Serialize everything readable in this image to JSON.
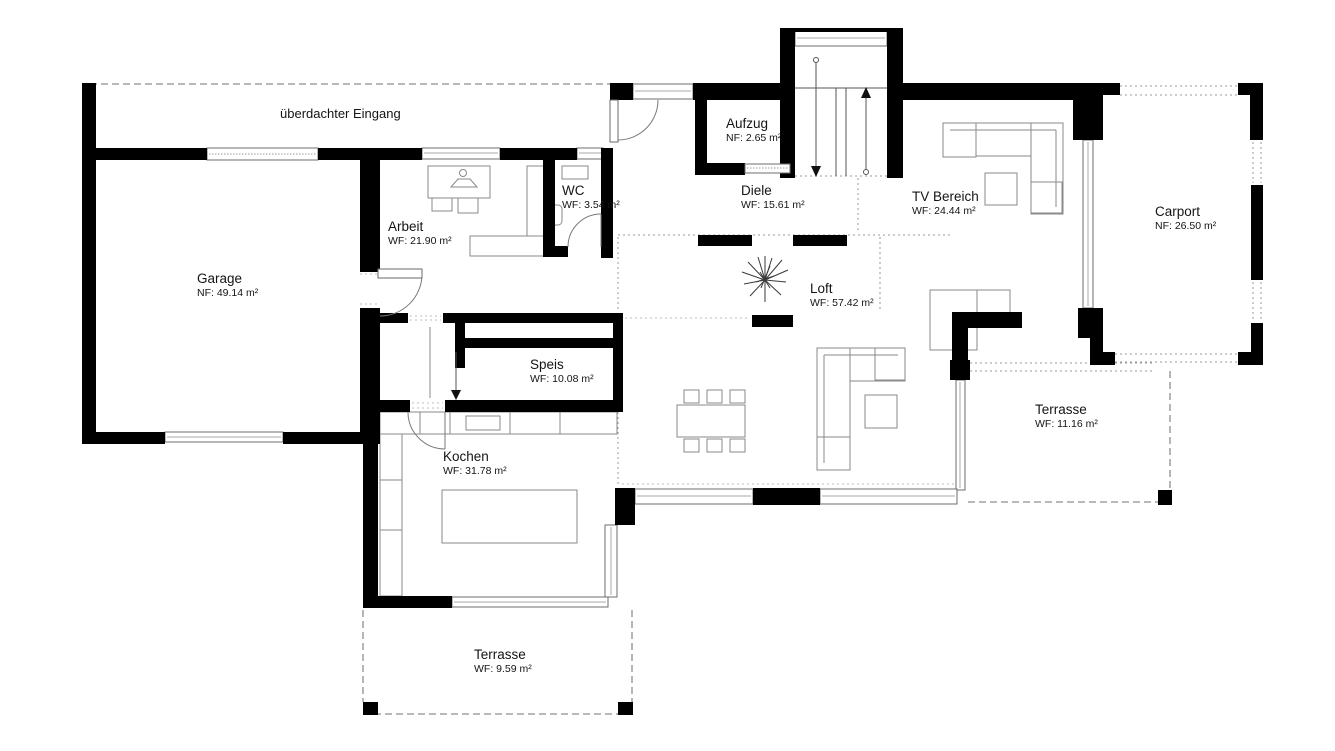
{
  "plan_type": "floor-plan",
  "rooms": {
    "eingang": {
      "name": "überdachter Eingang"
    },
    "garage": {
      "name": "Garage",
      "area": "NF: 49.14 m²"
    },
    "arbeit": {
      "name": "Arbeit",
      "area": "WF: 21.90 m²"
    },
    "wc": {
      "name": "WC",
      "area": "WF: 3.54 m²"
    },
    "aufzug": {
      "name": "Aufzug",
      "area": "NF: 2.65 m²"
    },
    "diele": {
      "name": "Diele",
      "area": "WF: 15.61 m²"
    },
    "tv": {
      "name": "TV Bereich",
      "area": "WF: 24.44 m²"
    },
    "carport": {
      "name": "Carport",
      "area": "NF: 26.50 m²"
    },
    "loft": {
      "name": "Loft",
      "area": "WF: 57.42 m²"
    },
    "speis": {
      "name": "Speis",
      "area": "WF: 10.08 m²"
    },
    "kochen": {
      "name": "Kochen",
      "area": "WF: 31.78 m²"
    },
    "terrasse_ost": {
      "name": "Terrasse",
      "area": "WF: 11.16 m²"
    },
    "terrasse_sued": {
      "name": "Terrasse",
      "area": "WF: 9.59 m²"
    }
  },
  "colors": {
    "wall": "#000000",
    "background": "#ffffff",
    "furniture_outline": "#8a8a8a",
    "dashed_boundary": "#8f8f8f",
    "text": "#141414"
  }
}
